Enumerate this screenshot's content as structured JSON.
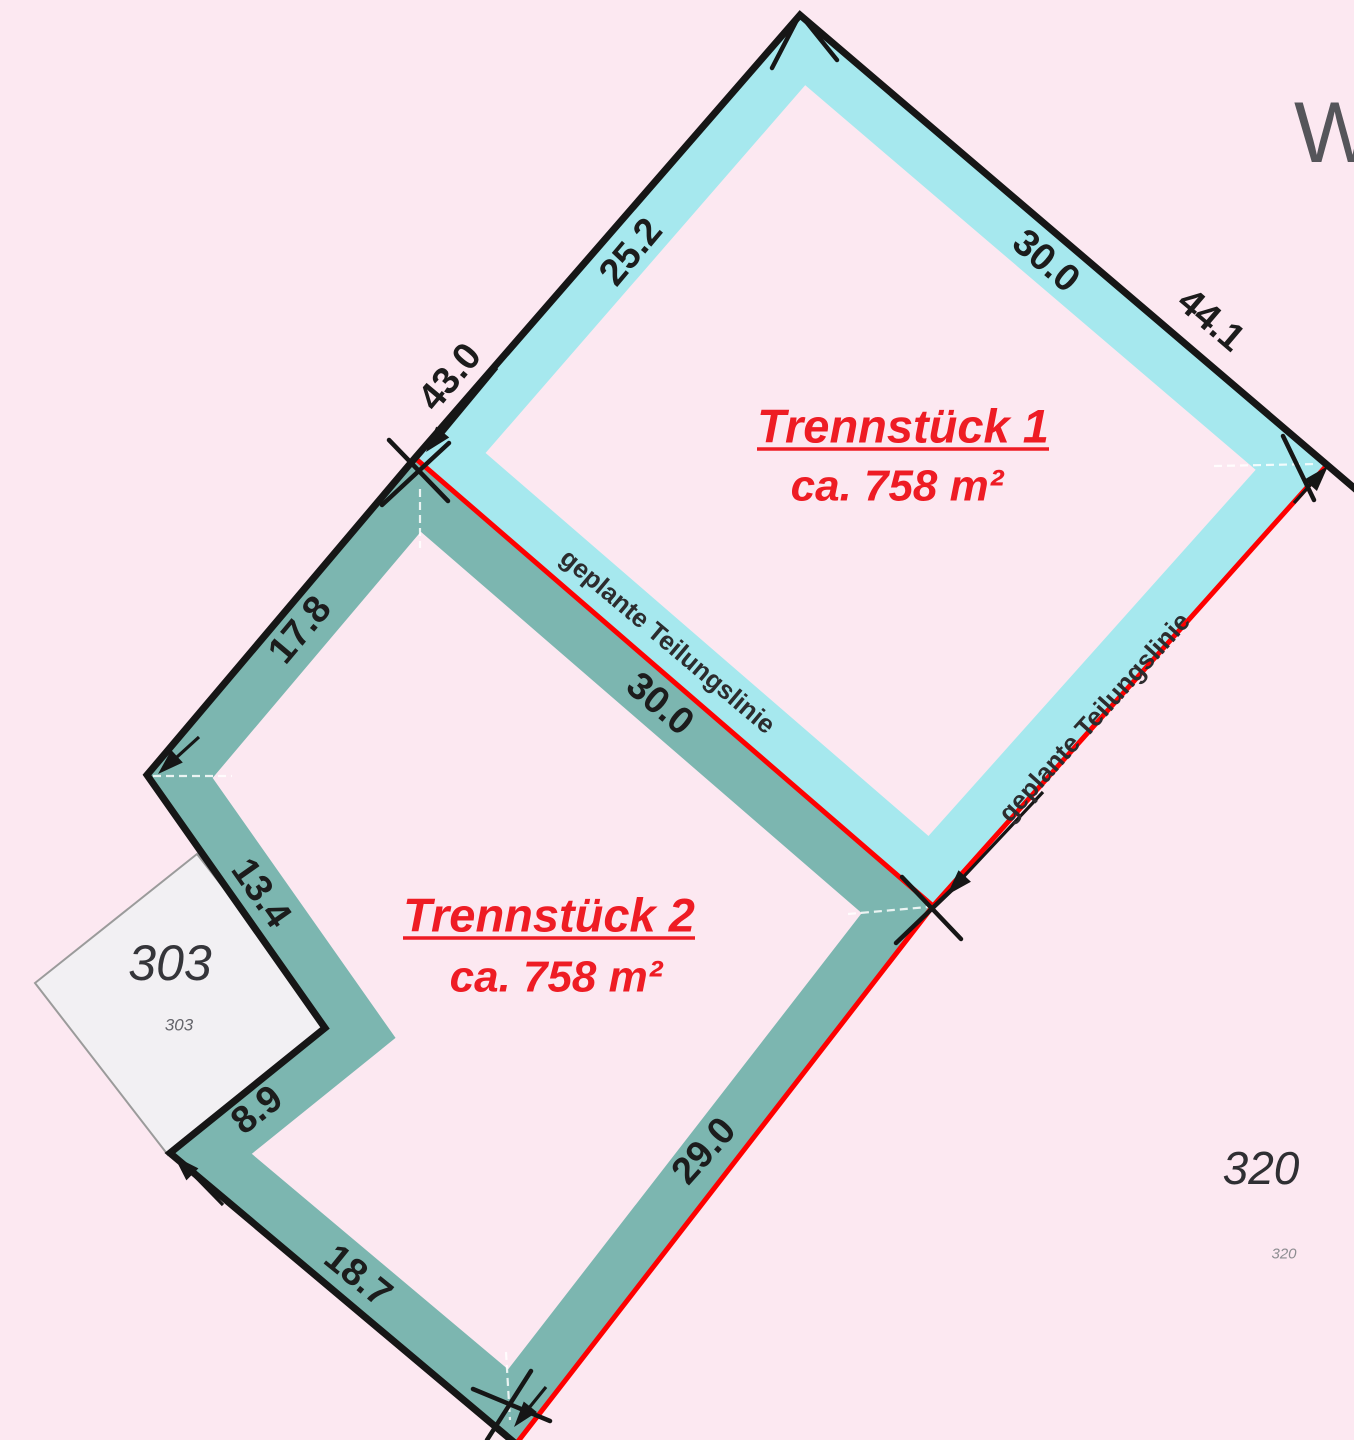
{
  "map": {
    "partial_label_top_right": "W-",
    "parcel1": {
      "title": "Trennstück 1",
      "area": "ca. 758 m²"
    },
    "parcel2": {
      "title": "Trennstück 2",
      "area": "ca. 758 m²"
    },
    "neighbor_parcels": {
      "p303": {
        "number": "303",
        "small_number": "303"
      },
      "p320": {
        "number": "320",
        "small_number": "320"
      }
    },
    "division_lines": {
      "middle_label": "geplante Teilungslinie",
      "right_label": "geplante Teilungslinie"
    },
    "dimensions": {
      "left_total": "43.0",
      "left_upper_segment": "25.2",
      "top_right_segment": "30.0",
      "top_right_total": "44.1",
      "left_lower_segment": "17.8",
      "notch_upper": "13.4",
      "notch_lower": "8.9",
      "bottom_left": "18.7",
      "bottom_right": "29.0",
      "middle_division": "30.0"
    }
  },
  "colors": {
    "background": "#fce8f1",
    "band_t1": "#a6e8ee",
    "band_t2": "#7cb6b0",
    "line_red": "#fe0000",
    "line_black": "#161616",
    "text_red": "#ee1c24",
    "text_dark": "#1c1c1c",
    "text_gray": "#2c2c2e",
    "parcel_fill_303": "#f2f0f3",
    "parcel_stroke_303": "#9b9b9b"
  }
}
